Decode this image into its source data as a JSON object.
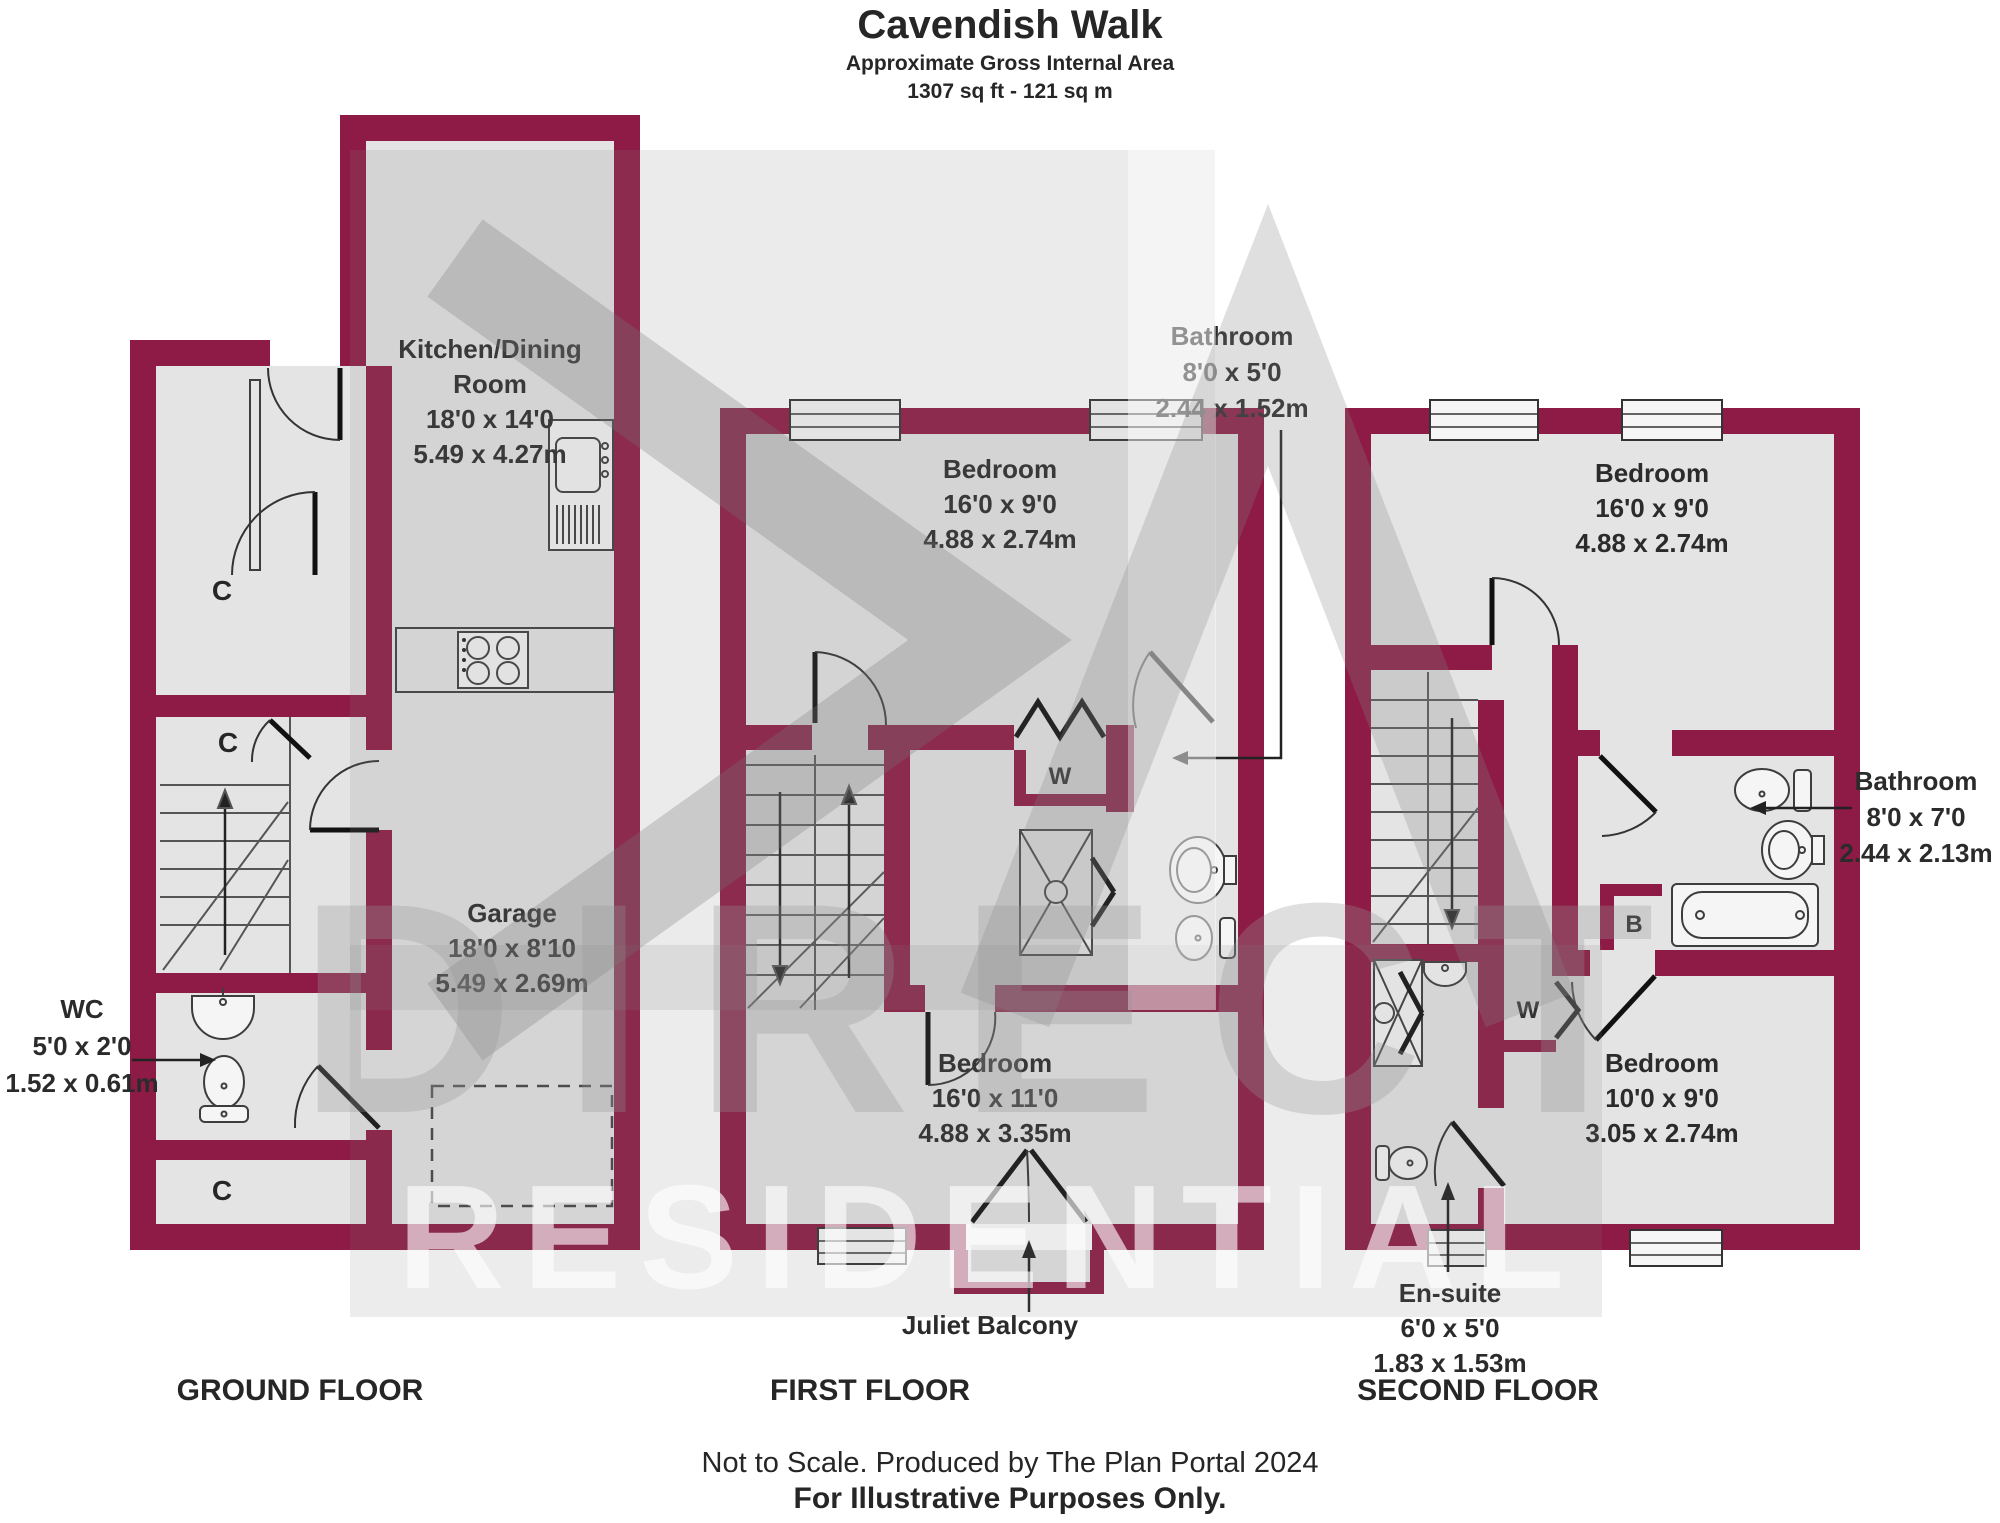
{
  "header": {
    "title": "Cavendish Walk",
    "subtitle": "Approximate Gross Internal Area",
    "area": "1307 sq ft - 121 sq m"
  },
  "rooms": {
    "kitchen": {
      "name": "Kitchen/Dining",
      "name2": "Room",
      "imperial": "18'0 x 14'0",
      "metric": "5.49 x 4.27m"
    },
    "garage": {
      "name": "Garage",
      "imperial": "18'0 x 8'10",
      "metric": "5.49 x 2.69m"
    },
    "wc": {
      "name": "WC",
      "imperial": "5'0 x 2'0",
      "metric": "1.52 x 0.61m"
    },
    "bedroom1": {
      "name": "Bedroom",
      "imperial": "16'0 x 9'0",
      "metric": "4.88 x 2.74m"
    },
    "bathroom1": {
      "name": "Bathroom",
      "imperial": "8'0 x 5'0",
      "metric": "2.44 x 1.52m"
    },
    "bedroom2": {
      "name": "Bedroom",
      "imperial": "16'0 x 11'0",
      "metric": "4.88 x 3.35m"
    },
    "juliet": {
      "name": "Juliet Balcony"
    },
    "bedroom3": {
      "name": "Bedroom",
      "imperial": "16'0 x 9'0",
      "metric": "4.88 x 2.74m"
    },
    "bathroom2": {
      "name": "Bathroom",
      "imperial": "8'0 x 7'0",
      "metric": "2.44 x 2.13m"
    },
    "bedroom4": {
      "name": "Bedroom",
      "imperial": "10'0 x 9'0",
      "metric": "3.05 x 2.74m"
    },
    "ensuite": {
      "name": "En-suite",
      "imperial": "6'0 x 5'0",
      "metric": "1.83 x 1.53m"
    }
  },
  "labels": {
    "closet": "C",
    "wardrobe": "W",
    "boiler": "B"
  },
  "floors": {
    "ground": "GROUND FLOOR",
    "first": "FIRST FLOOR",
    "second": "SECOND FLOOR"
  },
  "footer": {
    "line1": "Not to Scale. Produced by The Plan Portal 2024",
    "line2": "For Illustrative Purposes Only."
  },
  "watermark": {
    "line1": "DIRECT",
    "line2": "RESIDENTIAL"
  },
  "colors": {
    "wall": "#8E1B45",
    "room_fill": "#E4E4E4",
    "background": "#FFFFFF",
    "watermark_gray": "#C8C8C8"
  }
}
